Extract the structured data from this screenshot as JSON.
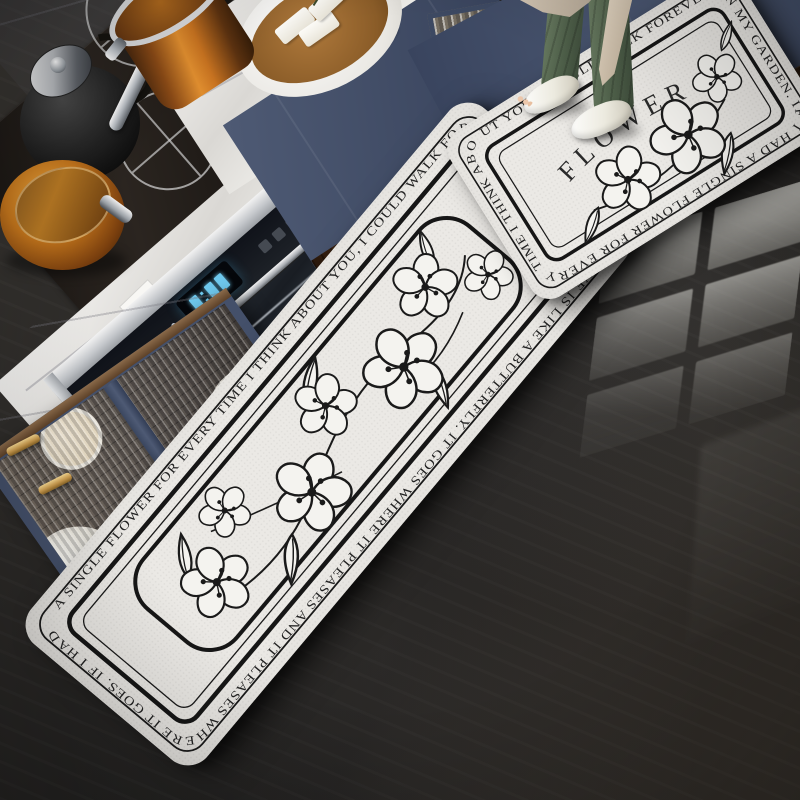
{
  "scene": {
    "setting": "modern kitchen with dark glossy stone floor, navy cabinets and marble counters",
    "subject": "two-piece anti-slip kitchen floor mat set with black and white floral line art"
  },
  "mat_large": {
    "quote": "IF I HAD A SINGLE FLOWER FOR EVERY TIME I THINK ABOUT YOU, I COULD WALK FOREVER IN MY GARDEN. LOVE IS LIKE A BUTTERFLY. IT GOES WHERE IT PLEASES AND IT PLEASES WHERE IT GOES.",
    "border_text": "A SINGLE FLOWER FOR EVERY TIME I THINK ABOUT YOU,  I COULD WALK FOREVER IN MY GARDEN.   LOVE IS LIKE A BUTTERFLY.  IT GOES WHERE IT PLEASES AND IT PLEASES WHERE IT GOES.   IF I HAD "
  },
  "mat_small": {
    "border_text": "UT YOU,  I COULD WALK FOREVER IN MY GARDEN.   IF I HAD A SINGLE FLOWER FOR EVERY TIME I THINK ABO",
    "center_text": "FLOWER"
  },
  "palette": {
    "floor_dark": "#242322",
    "mat_base": "#ebe9e5",
    "mat_ink": "#1a1a1a",
    "cabinet_navy": "#4a5670",
    "gold_brass": "#c99a4e",
    "marble_white": "#f2f1ee",
    "copper": "#c47a24",
    "wood_dark": "#58381f",
    "pants_green": "#5b6f58",
    "apron_beige": "#cfc2b0",
    "slipper_white": "#f2eee7",
    "oven_display_cyan": "#6fc9ee"
  }
}
